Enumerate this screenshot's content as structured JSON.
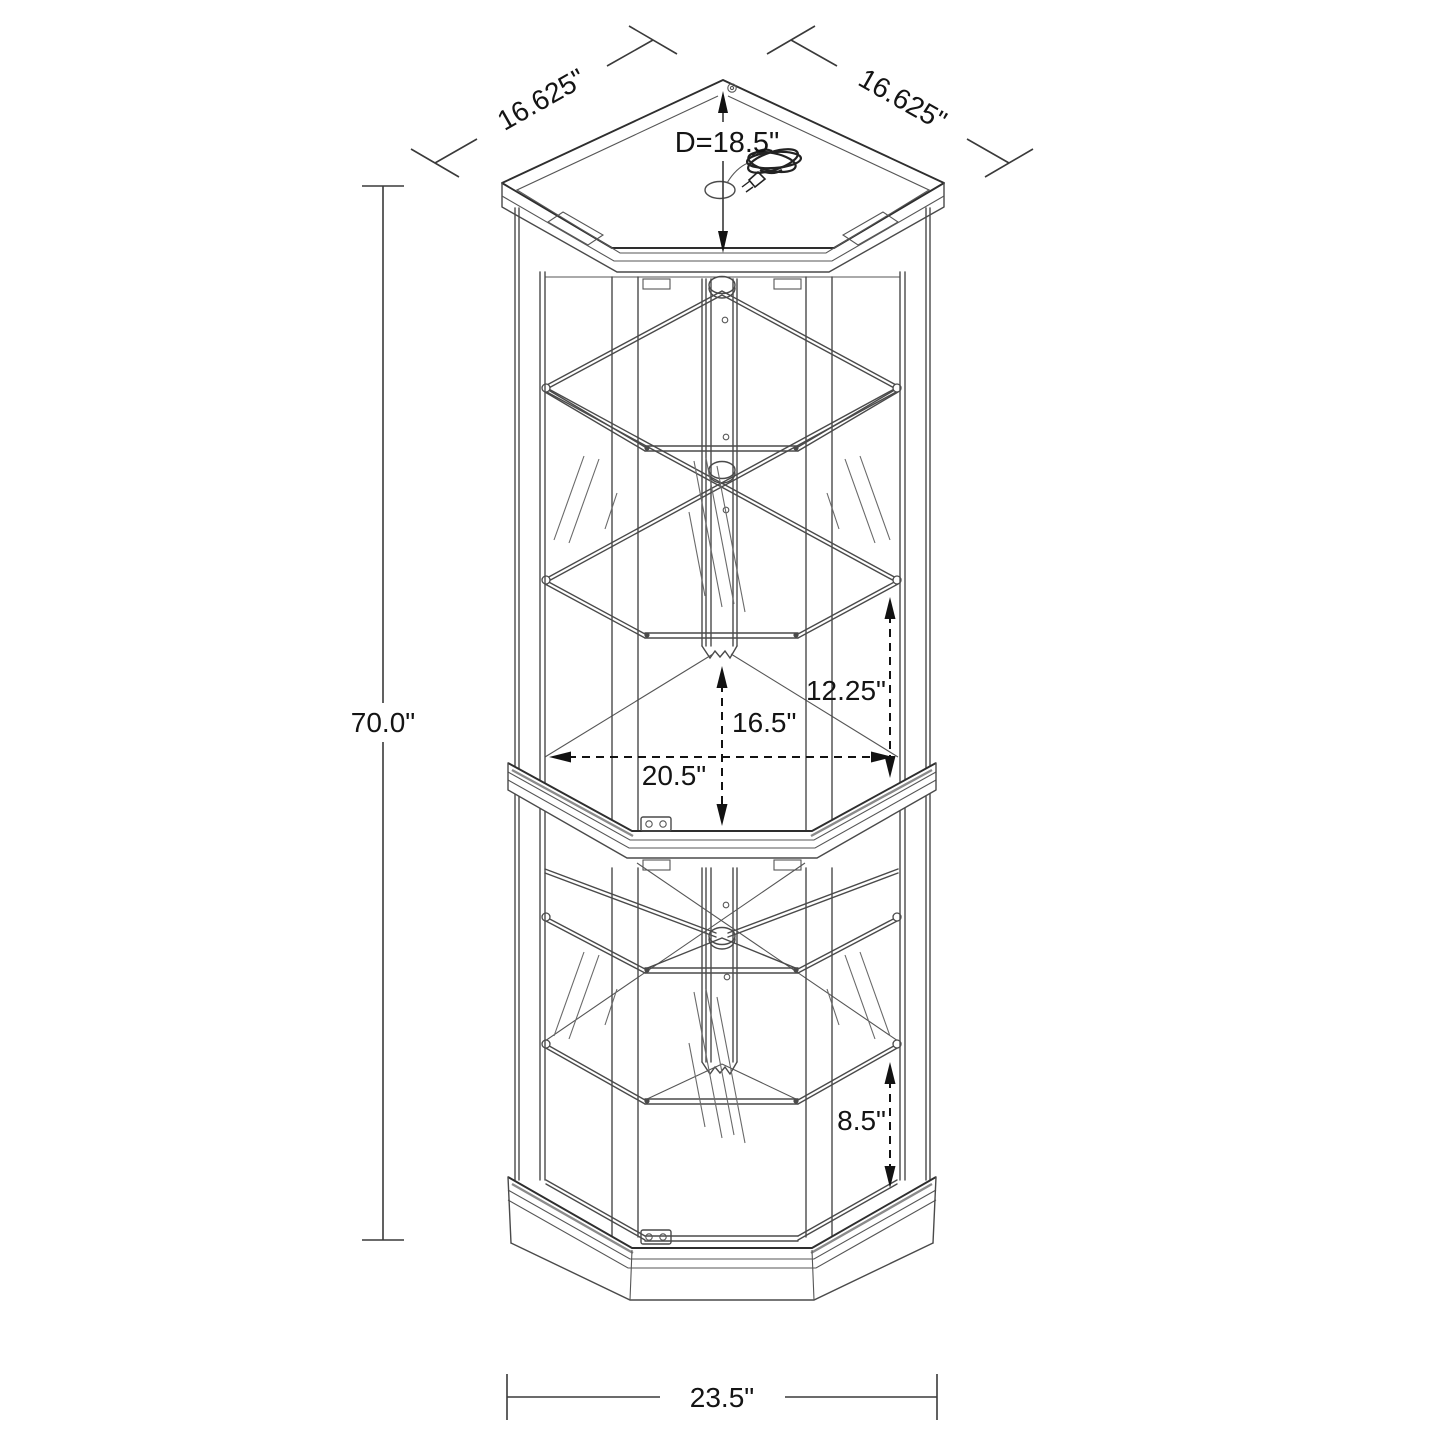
{
  "drawing": {
    "type": "furniture-dimension-diagram",
    "subject": "Corner curio display cabinet line drawing",
    "background_color": "#ffffff",
    "line_color": "#4a4a4a",
    "dimension_color": "#121212"
  },
  "dimensions": {
    "top_left_edge": {
      "label": "16.625\""
    },
    "top_right_edge": {
      "label": "16.625\""
    },
    "top_depth": {
      "label": "D=18.5\""
    },
    "overall_height": {
      "label": "70.0\""
    },
    "interior_width": {
      "label": "20.5\""
    },
    "upper_center_clearance": {
      "label": "16.5\""
    },
    "upper_side_clearance": {
      "label": "12.25\""
    },
    "lower_side_clearance": {
      "label": "8.5\""
    },
    "base_width": {
      "label": "23.5\""
    }
  }
}
